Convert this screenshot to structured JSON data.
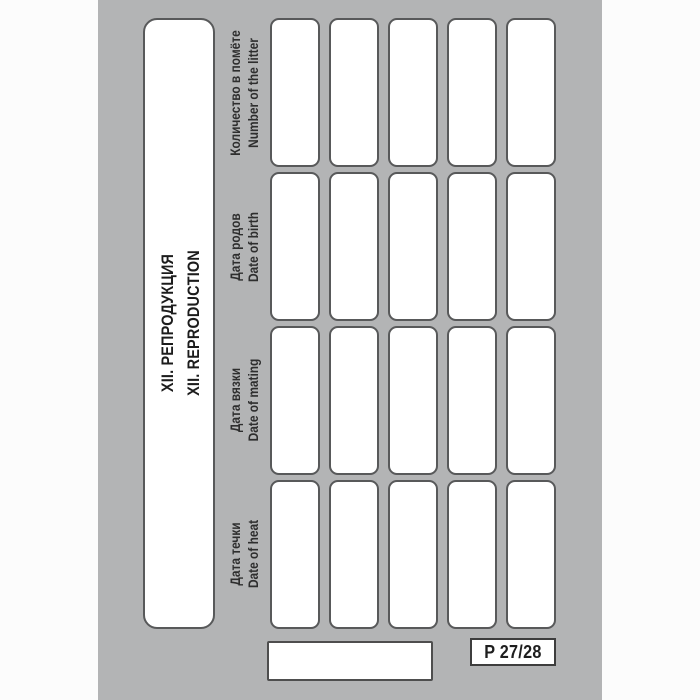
{
  "section": {
    "title_ru": "XII. РЕПРОДУКЦИЯ",
    "title_en": "XII. REPRODUCTION"
  },
  "table": {
    "column_headers": [
      {
        "ru": "Количество в помёте",
        "en": "Number of the litter"
      },
      {
        "ru": "Дата родов",
        "en": "Date of birth"
      },
      {
        "ru": "Дата вязки",
        "en": "Date of mating"
      },
      {
        "ru": "Дата течки",
        "en": "Date of heat"
      }
    ],
    "entry_rows": 5,
    "fields_per_entry": 4
  },
  "footer": {
    "page_number": "P 27/28"
  },
  "colors": {
    "page_bg": "#b3b4b5",
    "cell_fill": "#ffffff",
    "cell_border": "#58595a",
    "text": "#262626"
  }
}
